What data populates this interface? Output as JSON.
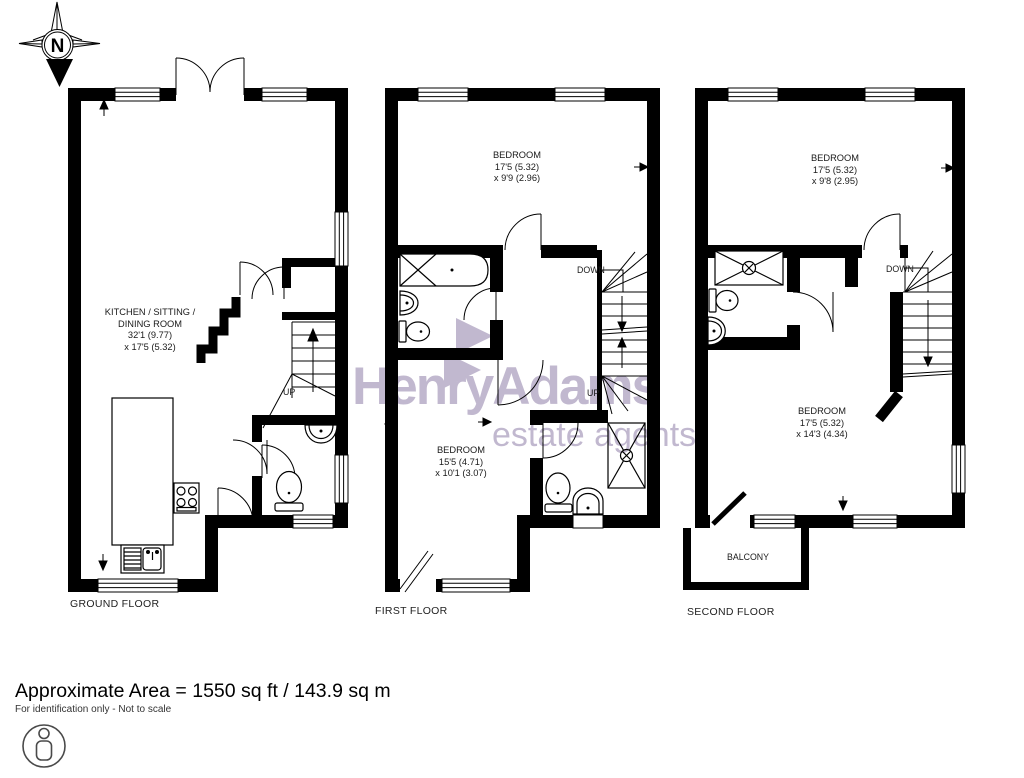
{
  "compass": {
    "north_label": "N"
  },
  "watermark": {
    "brand": "HenryAdams",
    "tagline": "estate agents",
    "color": "#84719f"
  },
  "ground_floor": {
    "floor_label": "GROUND FLOOR",
    "room": {
      "line1": "KITCHEN / SITTING /",
      "line2": "DINING ROOM",
      "line3": "32'1 (9.77)",
      "line4": "x 17'5 (5.32)"
    },
    "stairs_up_label": "UP"
  },
  "first_floor": {
    "floor_label": "FIRST FLOOR",
    "bedroom_rear": {
      "line1": "BEDROOM",
      "line2": "17'5 (5.32)",
      "line3": "x 9'9 (2.96)"
    },
    "bedroom_front": {
      "line1": "BEDROOM",
      "line2": "15'5 (4.71)",
      "line3": "x 10'1 (3.07)"
    },
    "stairs_down_label": "DOWN",
    "stairs_up_label": "UP"
  },
  "second_floor": {
    "floor_label": "SECOND FLOOR",
    "bedroom_rear": {
      "line1": "BEDROOM",
      "line2": "17'5 (5.32)",
      "line3": "x 9'8 (2.95)"
    },
    "bedroom_front": {
      "line1": "BEDROOM",
      "line2": "17'5 (5.32)",
      "line3": "x 14'3 (4.34)"
    },
    "stairs_down_label": "DOWN",
    "balcony_label": "BALCONY"
  },
  "footer": {
    "area_text": "Approximate Area = 1550 sq ft / 143.9 sq m",
    "disclaimer": "For identification only - Not to scale"
  }
}
